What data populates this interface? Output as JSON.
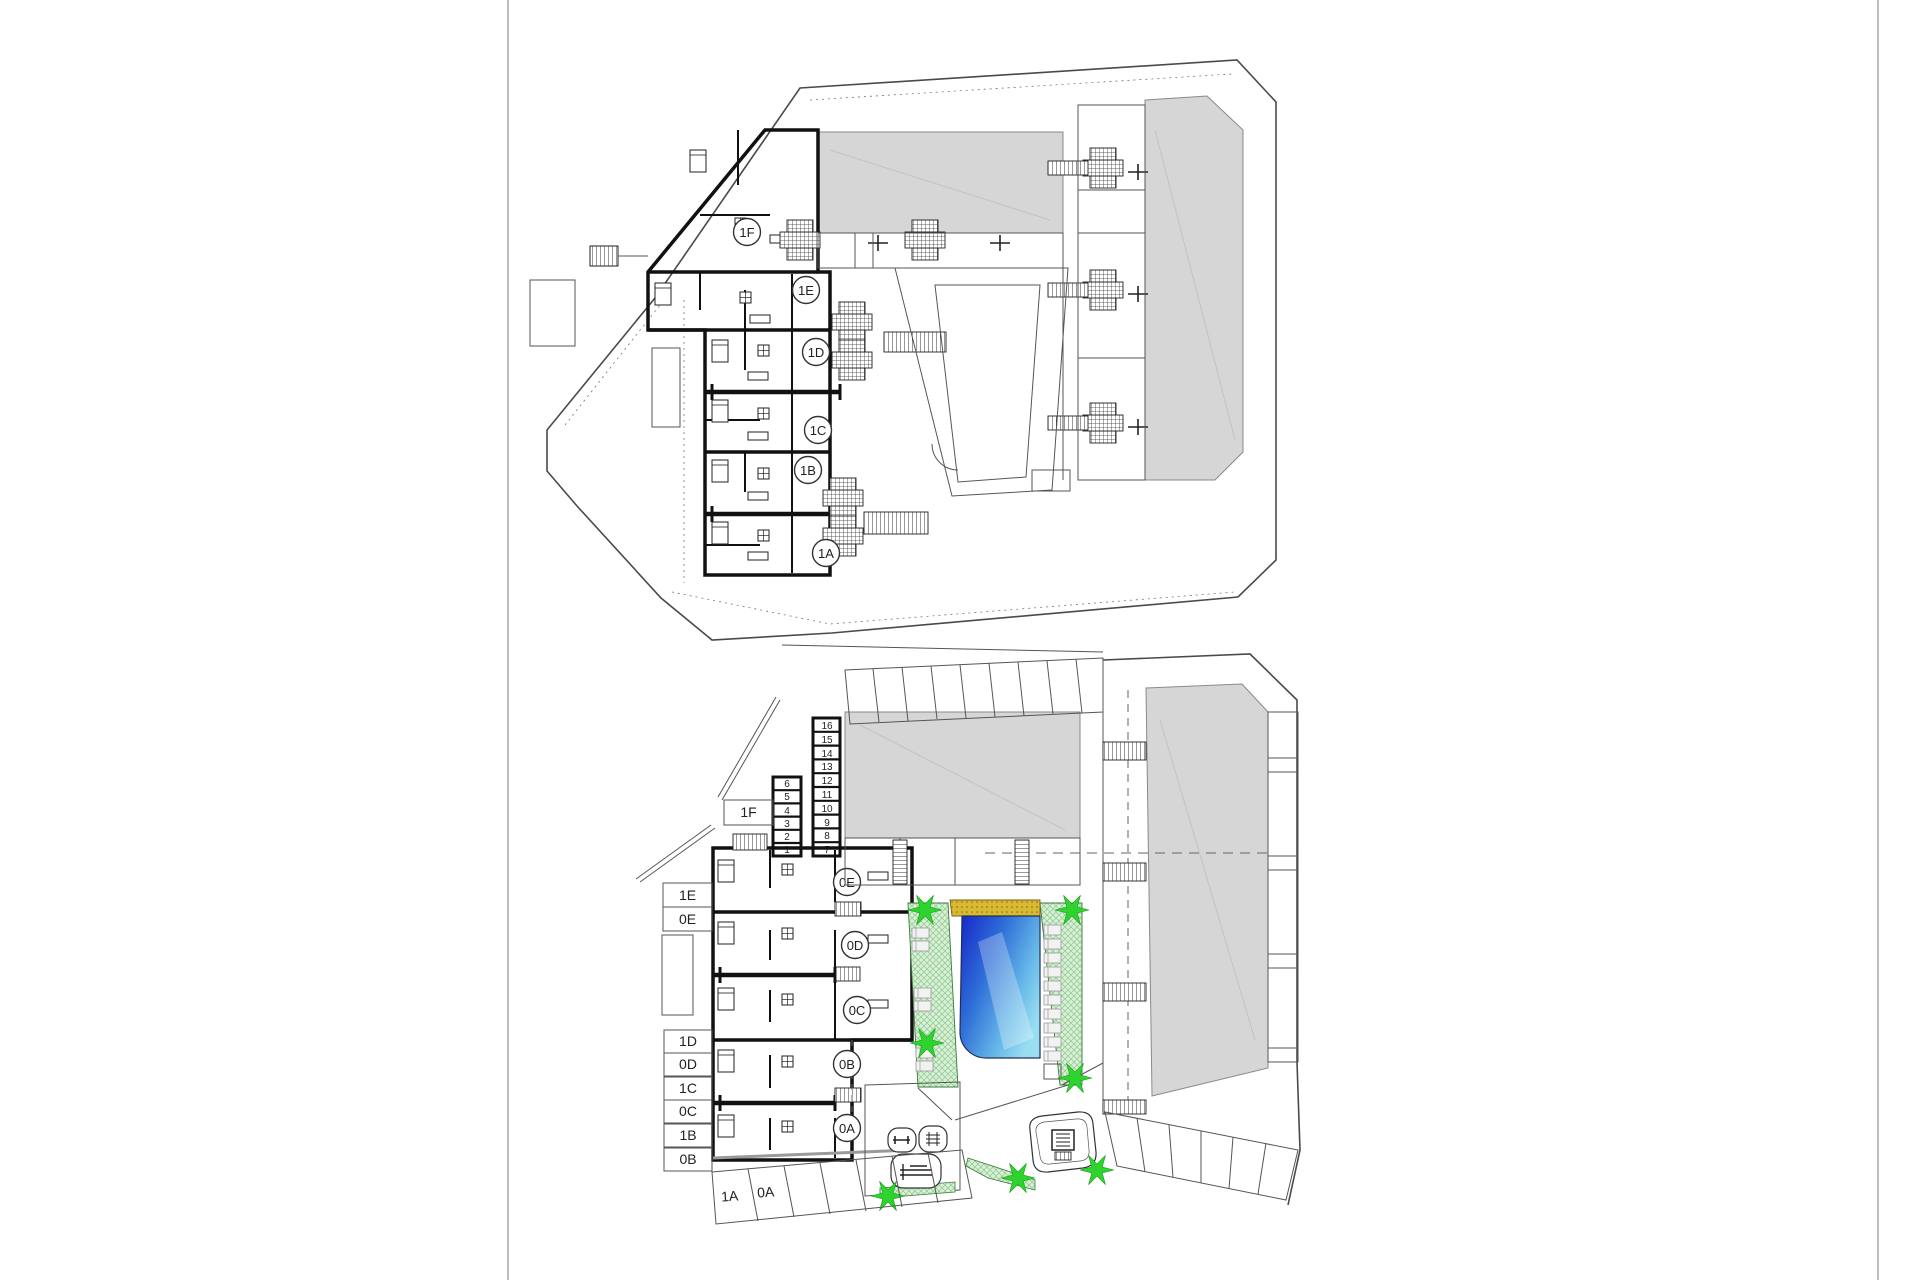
{
  "document": {
    "type": "architectural floor plans",
    "sheet_background": "#ffffff",
    "sheet_border_color": "#909090"
  },
  "colors": {
    "wall": "#111111",
    "building_mass_gray": "#d6d6d6",
    "deck_green": "#d9efd6",
    "deck_green_hatch": "#8cc98c",
    "tree_green": "#2ed32e",
    "pool_dark_blue": "#1726c8",
    "pool_light_blue": "#9adef2",
    "sun_strip_yellow": "#d9b832"
  },
  "upper": {
    "name": "first-floor-plan",
    "units": [
      "1F",
      "1E",
      "1D",
      "1C",
      "1B",
      "1A"
    ]
  },
  "lower": {
    "name": "ground-floor-site-plan",
    "circles": [
      "0E",
      "0D",
      "0C",
      "0B",
      "0A"
    ],
    "boxes": [
      "1F",
      "1E",
      "0E",
      "1D",
      "0D",
      "1C",
      "0C",
      "1B",
      "0B"
    ],
    "parking": [
      "1A",
      "0A"
    ],
    "storage_left": [
      "6",
      "5",
      "4",
      "3",
      "2",
      "1"
    ],
    "storage_right": [
      "16",
      "15",
      "14",
      "13",
      "12",
      "11",
      "10",
      "9",
      "8",
      "7"
    ]
  }
}
